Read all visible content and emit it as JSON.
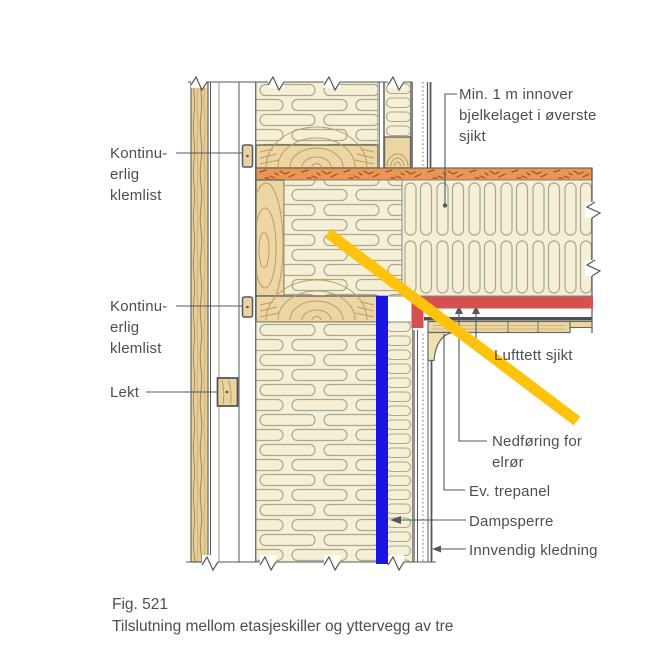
{
  "figure": {
    "fig_number": "Fig. 521",
    "caption": "Tilslutning mellom etasjeskiller og yttervegg av tre"
  },
  "labels": {
    "klemlist_top": "Kontinu-\nerlig\nklemlist",
    "klemlist_bottom": "Kontinu-\nerlig\nklemlist",
    "lekt": "Lekt",
    "min_innover": "Min. 1 m innover\nbjelkelaget i øverste\nsjikt",
    "lufttett_sjikt": "Lufttett sjikt",
    "nedforing": "Nedføring for\nelrør",
    "ev_trepanel": "Ev. trepanel",
    "dampsperre": "Dampsperre",
    "innvendig_kledning": "Innvendig kledning"
  },
  "colors": {
    "highlight_yellow": "#FFC20D",
    "highlight_red": "#D5504E",
    "highlight_blue": "#1A15E0",
    "insulation_fill": "#F5F0D5",
    "wood_fill": "#ECD7A4",
    "subfloor_orange": "#E89755",
    "drawing_line": "#55575C",
    "text_color": "#4B4E52"
  }
}
